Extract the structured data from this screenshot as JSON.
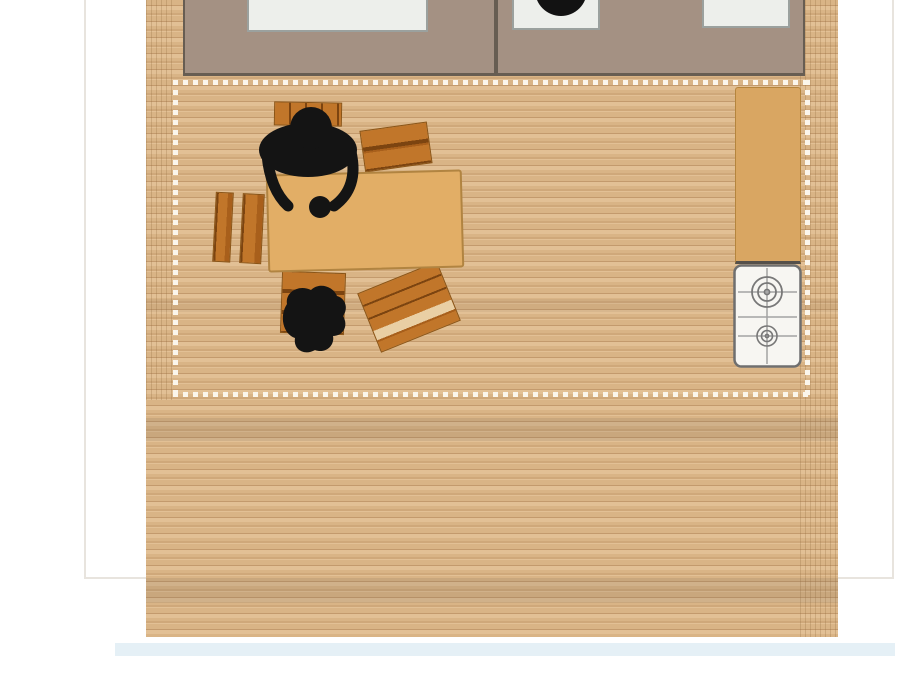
{
  "scene": {
    "type": "floor-plan",
    "view": "top-down",
    "room": "kitchen and dining room",
    "palette": {
      "background": "#ffffff",
      "outline": "#e8e4de",
      "floor_base": "#d9b486",
      "floor_light": "#e2c095",
      "floor_dark": "#cfa87a",
      "floor_seam": "#c39a6d",
      "hatch_line": "rgba(146,108,62,0.28)",
      "band_shade": "rgba(120,100,80,0.16)",
      "dash": "#fbf6ec",
      "counter": "#a49183",
      "counter_border": "#675d52",
      "appliance": "#edefeb",
      "appliance_border": "#9ba19e",
      "basin": "#121212",
      "cabinet": "#d9a662",
      "cabinet_border": "#b5853d",
      "stove_body": "#f7f6f2",
      "stove_border": "#6f6f6f",
      "stove_grate": "#a3a3a3",
      "burner": "#787878",
      "table": "#e2ae66",
      "table_border": "#b18441",
      "chair": "#c1762a",
      "chair_dark": "#7c4410",
      "chair_mid": "#a85f1b",
      "chair_light": "#e9cfa4",
      "chair_border": "#8a5416",
      "person": "#141414",
      "shadow_band": "rgba(203,226,238,0.5)"
    },
    "elements": {
      "counters": 2,
      "built_in_appliances": 3,
      "sink_basin": "round black basin on middle appliance",
      "tall_cabinet": "tan worktop cabinet on right wall",
      "stove": {
        "label": "gas cooktop",
        "burners": 2
      },
      "dining_table": "rectangular wooden table",
      "chairs": 5,
      "people": 2,
      "dashed_zone": "dotted boundary around dining area",
      "floor": "wooden plank flooring"
    }
  }
}
